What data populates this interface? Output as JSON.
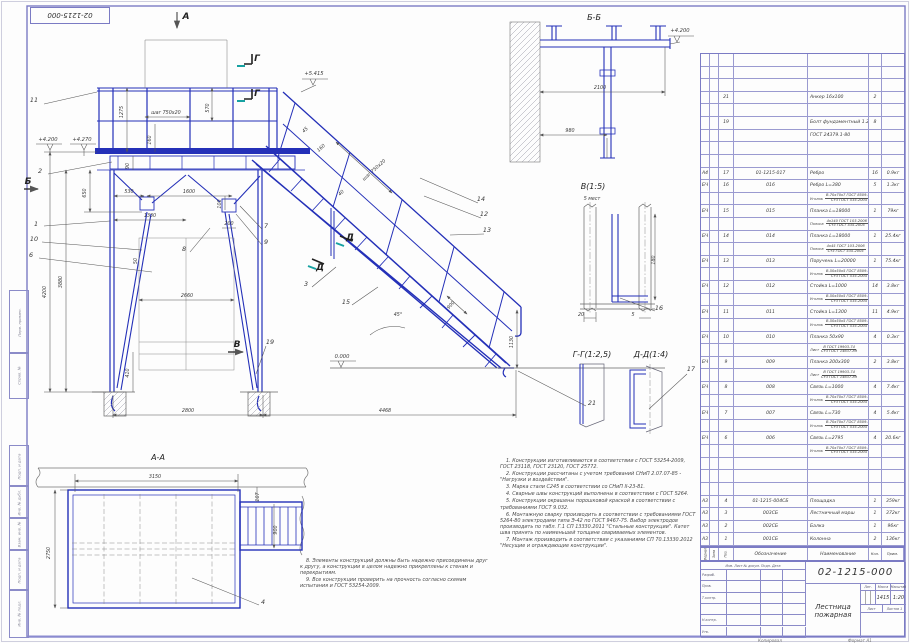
{
  "sheet": {
    "code_stamp": "02-1215-000",
    "copied_label": "Копировал",
    "format_label": "Формат А1"
  },
  "margin_labels": [
    "Перв. примен.",
    "Справ. №",
    "Подп. и дата",
    "Инв. № дубл.",
    "Взам. инв. №",
    "Подп. и дата",
    "Инв. № подл."
  ],
  "notes": {
    "left": [
      "8. Элементы конструкций должны быть надежно присоединены друг к другу, а конструкции в целом надежно прикреплены к стенам и перекрытиям.",
      "9. Все конструкции проверить на прочность согласно схемам испытания и ГОСТ 53254-2009."
    ],
    "right": [
      "1. Конструкции изготавливаются в соответствии с ГОСТ 53254-2009, ГОСТ 23118, ГОСТ 23120, ГОСТ 25772.",
      "2. Конструкции рассчитаны с учетом требований СНиП 2.07.07-85 - \"Нагрузки и воздействия\".",
      "3. Марка стали С245 в соответствии со СНиП II-23-81.",
      "4. Сварные швы конструкций выполнены в соответствии с ГОСТ 5264.",
      "5. Конструкции окрашены порошковой краской в соответствии с требованиями ГОСТ 9.032.",
      "6. Монтажную сварку производить в соответствии с требованиями ГОСТ 5264-80 электродами типа Э-42 по ГОСТ 9467-75. Выбор электродов производить по табл. Г.1 СП 13330.2011 \"Стальные конструкции\". Катет шва принять по наименьшей толщине свариваемых элементов.",
      "7. Монтаж производить в соответствии с указаниями СП 70.13330.2012 \"Несущие и ограждающие конструкции\"."
    ]
  },
  "spec": {
    "header": {
      "format": "Формат",
      "zone": "Зона",
      "pos": "Поз.",
      "designation": "Обозначение",
      "name": "Наименование",
      "qty": "Кол.",
      "note": "Прим."
    },
    "rows": [
      {
        "t": "e"
      },
      {
        "t": "e"
      },
      {
        "t": "e"
      },
      {
        "t": "i",
        "f": "",
        "p": "21",
        "d": "",
        "n": "Анкер 16х100",
        "q": "2",
        "m": ""
      },
      {
        "t": "e"
      },
      {
        "t": "i",
        "f": "",
        "p": "19",
        "d": "",
        "n": "Болт фундаментный 1.2М20х400",
        "q": "8",
        "m": ""
      },
      {
        "t": "c",
        "n": "ГОСТ 24379.1-80"
      },
      {
        "t": "e"
      },
      {
        "t": "e"
      },
      {
        "t": "i",
        "f": "А4",
        "p": "17",
        "d": "01-1215-017",
        "n": "Ребро",
        "q": "16",
        "m": "0.9кг"
      },
      {
        "t": "i",
        "f": "БЧ",
        "p": "16",
        "d": "016",
        "n": "Ребро L=380",
        "q": "5",
        "m": "1.3кг"
      },
      {
        "t": "s",
        "lbl": "Уголок",
        "top": "В-70х70х7 ГОСТ 8509-93",
        "bot": "Ст3 ГОСТ 535-2005"
      },
      {
        "t": "i",
        "f": "БЧ",
        "p": "15",
        "d": "015",
        "n": "Планка L=18000",
        "q": "1",
        "m": "79кг"
      },
      {
        "t": "s",
        "lbl": "Полоса",
        "top": "4х140 ГОСТ 103-2006",
        "bot": "Ст3 ГОСТ 535-2005"
      },
      {
        "t": "i",
        "f": "БЧ",
        "p": "14",
        "d": "014",
        "n": "Планка L=18000",
        "q": "1",
        "m": "25.4кг"
      },
      {
        "t": "s",
        "lbl": "Полоса",
        "top": "4х45 ГОСТ 103-2006",
        "bot": "Ст3 ГОСТ 535-2005"
      },
      {
        "t": "i",
        "f": "БЧ",
        "p": "13",
        "d": "013",
        "n": "Поручень L=20000",
        "q": "1",
        "m": "75.4кг"
      },
      {
        "t": "s",
        "lbl": "Уголок",
        "top": "В-50х50х5 ГОСТ 8509-93",
        "bot": "Ст3 ГОСТ 535-2005"
      },
      {
        "t": "i",
        "f": "БЧ",
        "p": "12",
        "d": "012",
        "n": "Стойка L=1000",
        "q": "14",
        "m": "3.8кг"
      },
      {
        "t": "s",
        "lbl": "Уголок",
        "top": "В-50х50х5 ГОСТ 8509-93",
        "bot": "Ст3 ГОСТ 535-2005"
      },
      {
        "t": "i",
        "f": "БЧ",
        "p": "11",
        "d": "011",
        "n": "Стойка L=1300",
        "q": "11",
        "m": "4.9кг"
      },
      {
        "t": "s",
        "lbl": "Уголок",
        "top": "В-50х50х5 ГОСТ 8509-93",
        "bot": "Ст3 ГОСТ 535-2005"
      },
      {
        "t": "i",
        "f": "БЧ",
        "p": "10",
        "d": "010",
        "n": "Планка 50х90",
        "q": "4",
        "m": "0.3кг"
      },
      {
        "t": "s",
        "lbl": "Лист",
        "top": "В ГОСТ 19903-74",
        "bot": "Ст3 ГОСТ 14637-89"
      },
      {
        "t": "i",
        "f": "БЧ",
        "p": "9",
        "d": "009",
        "n": "Планка 200х300",
        "q": "2",
        "m": "3.8кг"
      },
      {
        "t": "s",
        "lbl": "Лист",
        "top": "В ГОСТ 19903-74",
        "bot": "Ст3 ГОСТ 14637-89"
      },
      {
        "t": "i",
        "f": "БЧ",
        "p": "8",
        "d": "008",
        "n": "Связь L=1000",
        "q": "4",
        "m": "7.4кг"
      },
      {
        "t": "s",
        "lbl": "Уголок",
        "top": "В-70х70х7 ГОСТ 8509-93",
        "bot": "Ст3 ГОСТ 535-2005"
      },
      {
        "t": "i",
        "f": "БЧ",
        "p": "7",
        "d": "007",
        "n": "Связь L=730",
        "q": "4",
        "m": "5.4кг"
      },
      {
        "t": "s",
        "lbl": "Уголок",
        "top": "В-70х70х7 ГОСТ 8509-93",
        "bot": "Ст3 ГОСТ 535-2005"
      },
      {
        "t": "i",
        "f": "БЧ",
        "p": "6",
        "d": "006",
        "n": "Связь L=2795",
        "q": "4",
        "m": "20.6кг"
      },
      {
        "t": "s",
        "lbl": "Уголок",
        "top": "В-70х70х7 ГОСТ 8509-93",
        "bot": "Ст3 ГОСТ 535-2005"
      },
      {
        "t": "e"
      },
      {
        "t": "e"
      },
      {
        "t": "e"
      },
      {
        "t": "i",
        "f": "А3",
        "p": "4",
        "d": "01-1215-004СБ",
        "n": "Площадка",
        "q": "1",
        "m": "359кг"
      },
      {
        "t": "i",
        "f": "А3",
        "p": "3",
        "d": "003СБ",
        "n": "Лестничный марш",
        "q": "1",
        "m": "372кг"
      },
      {
        "t": "i",
        "f": "А3",
        "p": "2",
        "d": "002СБ",
        "n": "Балка",
        "q": "1",
        "m": "96кг"
      },
      {
        "t": "i",
        "f": "А3",
        "p": "1",
        "d": "001СБ",
        "n": "Колонна",
        "q": "2",
        "m": "136кг"
      }
    ]
  },
  "title_block": {
    "doc_number": "02-1215-000",
    "title": "Лестница пожарная",
    "cols": [
      "Изм.",
      "Лист",
      "№ докум.",
      "Подп.",
      "Дата"
    ],
    "roles": [
      "Разраб.",
      "Пров.",
      "Т.контр.",
      "Н.контр.",
      "Утв."
    ],
    "lit_label": "Лит.",
    "mass_label": "Масса",
    "scale_label": "Масштаб",
    "mass": "1415",
    "scale": "1:20",
    "sheet_label": "Лист",
    "sheets_label": "Листов 1"
  },
  "drawing": {
    "labels": [
      {
        "t": "Б-Б",
        "x": 594,
        "y": 20,
        "c": "vt"
      },
      {
        "t": "В(1:5)",
        "x": 593,
        "y": 189,
        "c": "vt"
      },
      {
        "t": "5 мест",
        "x": 592,
        "y": 200,
        "c": "dim",
        "s": 5.5
      },
      {
        "t": "Г-Г(1:2,5)",
        "x": 592,
        "y": 357,
        "c": "vt"
      },
      {
        "t": "Д-Д(1:4)",
        "x": 651,
        "y": 357,
        "c": "vt"
      },
      {
        "t": "А-А",
        "x": 158,
        "y": 460,
        "c": "vt"
      },
      {
        "t": "+4.200",
        "x": 48,
        "y": 141,
        "c": "elev"
      },
      {
        "t": "+4.270",
        "x": 82,
        "y": 141,
        "c": "elev"
      },
      {
        "t": "+5.415",
        "x": 314,
        "y": 75,
        "c": "elev"
      },
      {
        "t": "0.000",
        "x": 342,
        "y": 358,
        "c": "elev"
      },
      {
        "t": "+4.200",
        "x": 680,
        "y": 32,
        "c": "elev"
      },
      {
        "t": "А",
        "x": 186,
        "y": 19,
        "c": "letter"
      },
      {
        "t": "Б",
        "x": 28,
        "y": 184,
        "c": "letter"
      },
      {
        "t": "В",
        "x": 237,
        "y": 347,
        "c": "letter"
      },
      {
        "t": "Г",
        "x": 257,
        "y": 61,
        "c": "letter"
      },
      {
        "t": "Г",
        "x": 257,
        "y": 96,
        "c": "letter"
      },
      {
        "t": "Д",
        "x": 320,
        "y": 270,
        "c": "letter"
      },
      {
        "t": "Д",
        "x": 350,
        "y": 240,
        "c": "letter"
      },
      {
        "t": "11",
        "x": 34,
        "y": 102,
        "c": "callout"
      },
      {
        "t": "2",
        "x": 40,
        "y": 173,
        "c": "callout"
      },
      {
        "t": "1",
        "x": 36,
        "y": 226,
        "c": "callout"
      },
      {
        "t": "10",
        "x": 34,
        "y": 241,
        "c": "callout"
      },
      {
        "t": "6",
        "x": 31,
        "y": 257,
        "c": "callout"
      },
      {
        "t": "8",
        "x": 184,
        "y": 251,
        "c": "callout"
      },
      {
        "t": "9",
        "x": 266,
        "y": 244,
        "c": "callout"
      },
      {
        "t": "7",
        "x": 266,
        "y": 228,
        "c": "callout"
      },
      {
        "t": "3",
        "x": 306,
        "y": 286,
        "c": "callout"
      },
      {
        "t": "15",
        "x": 346,
        "y": 304,
        "c": "callout"
      },
      {
        "t": "19",
        "x": 270,
        "y": 344,
        "c": "callout"
      },
      {
        "t": "21",
        "x": 592,
        "y": 405,
        "c": "callout"
      },
      {
        "t": "14",
        "x": 481,
        "y": 201,
        "c": "callout"
      },
      {
        "t": "12",
        "x": 484,
        "y": 216,
        "c": "callout"
      },
      {
        "t": "13",
        "x": 487,
        "y": 232,
        "c": "callout"
      },
      {
        "t": "16",
        "x": 659,
        "y": 310,
        "c": "callout"
      },
      {
        "t": "17",
        "x": 691,
        "y": 371,
        "c": "callout"
      },
      {
        "t": "4",
        "x": 263,
        "y": 604,
        "c": "callout"
      },
      {
        "t": "1275",
        "x": 123,
        "y": 112,
        "r": -90
      },
      {
        "t": "шаг 750х20",
        "x": 166,
        "y": 114
      },
      {
        "t": "570",
        "x": 209,
        "y": 108,
        "r": -90
      },
      {
        "t": "160",
        "x": 151,
        "y": 140,
        "r": -90
      },
      {
        "t": "90",
        "x": 129,
        "y": 166,
        "r": -90
      },
      {
        "t": "650",
        "x": 86,
        "y": 193,
        "r": -90
      },
      {
        "t": "530",
        "x": 129,
        "y": 193
      },
      {
        "t": "1600",
        "x": 189,
        "y": 193
      },
      {
        "t": "1330",
        "x": 150,
        "y": 217
      },
      {
        "t": "100",
        "x": 221,
        "y": 204,
        "r": -90
      },
      {
        "t": "200",
        "x": 229,
        "y": 225
      },
      {
        "t": "50",
        "x": 137,
        "y": 261,
        "r": -90
      },
      {
        "t": "2660",
        "x": 187,
        "y": 297
      },
      {
        "t": "3880",
        "x": 62,
        "y": 282,
        "r": -90
      },
      {
        "t": "4200",
        "x": 46,
        "y": 292,
        "r": -90
      },
      {
        "t": "410",
        "x": 129,
        "y": 373,
        "r": -90
      },
      {
        "t": "2800",
        "x": 188,
        "y": 412
      },
      {
        "t": "4468",
        "x": 385,
        "y": 412
      },
      {
        "t": "1130",
        "x": 513,
        "y": 342,
        "r": -90
      },
      {
        "t": "45°",
        "x": 398,
        "y": 316
      },
      {
        "t": "900",
        "x": 452,
        "y": 306,
        "r": -48
      },
      {
        "t": "45",
        "x": 306,
        "y": 131,
        "r": -42
      },
      {
        "t": "160",
        "x": 322,
        "y": 149,
        "r": -42
      },
      {
        "t": "шаг 750х20",
        "x": 375,
        "y": 171,
        "r": -42
      },
      {
        "t": "40",
        "x": 342,
        "y": 194,
        "r": -42
      },
      {
        "t": "2100",
        "x": 600,
        "y": 89
      },
      {
        "t": "980",
        "x": 570,
        "y": 132
      },
      {
        "t": "180",
        "x": 655,
        "y": 260,
        "r": -90
      },
      {
        "t": "20",
        "x": 581,
        "y": 316
      },
      {
        "t": "5",
        "x": 633,
        "y": 316
      },
      {
        "t": "3150",
        "x": 155,
        "y": 478
      },
      {
        "t": "107",
        "x": 259,
        "y": 497,
        "r": -90
      },
      {
        "t": "2750",
        "x": 50,
        "y": 553,
        "r": -90
      },
      {
        "t": "900",
        "x": 277,
        "y": 530,
        "r": -90
      }
    ]
  }
}
